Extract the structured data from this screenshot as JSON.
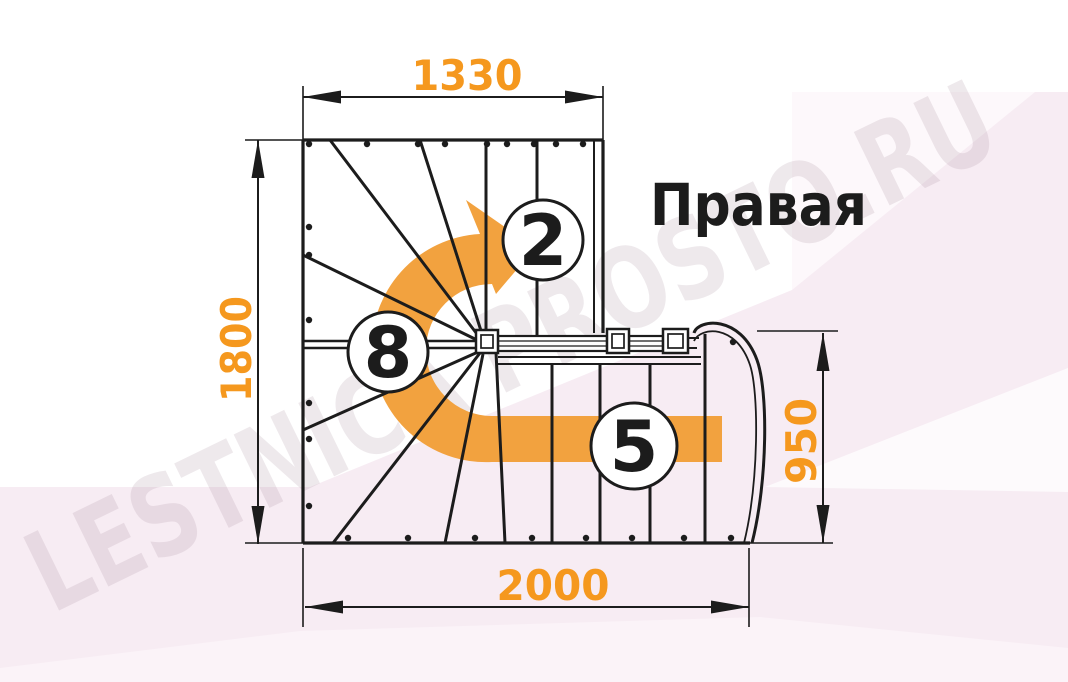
{
  "title": "Правая",
  "watermark": "LESTNICA PROSTO.RU",
  "dimensions": {
    "top_width_mm": "1330",
    "left_height_mm": "1800",
    "bottom_width_mm": "2000",
    "right_height_mm": "950"
  },
  "steps": {
    "upper_flight_count": "2",
    "winder_count": "8",
    "lower_flight_count": "5"
  },
  "colors": {
    "dimension_orange": "#F5981E",
    "arrow_orange": "#F2A23F",
    "line_black": "#1C1C1C",
    "background_pink": "#F7ECF3",
    "background_pink_light": "#FBF3F8",
    "circle_fill": "#FFFFFF"
  }
}
